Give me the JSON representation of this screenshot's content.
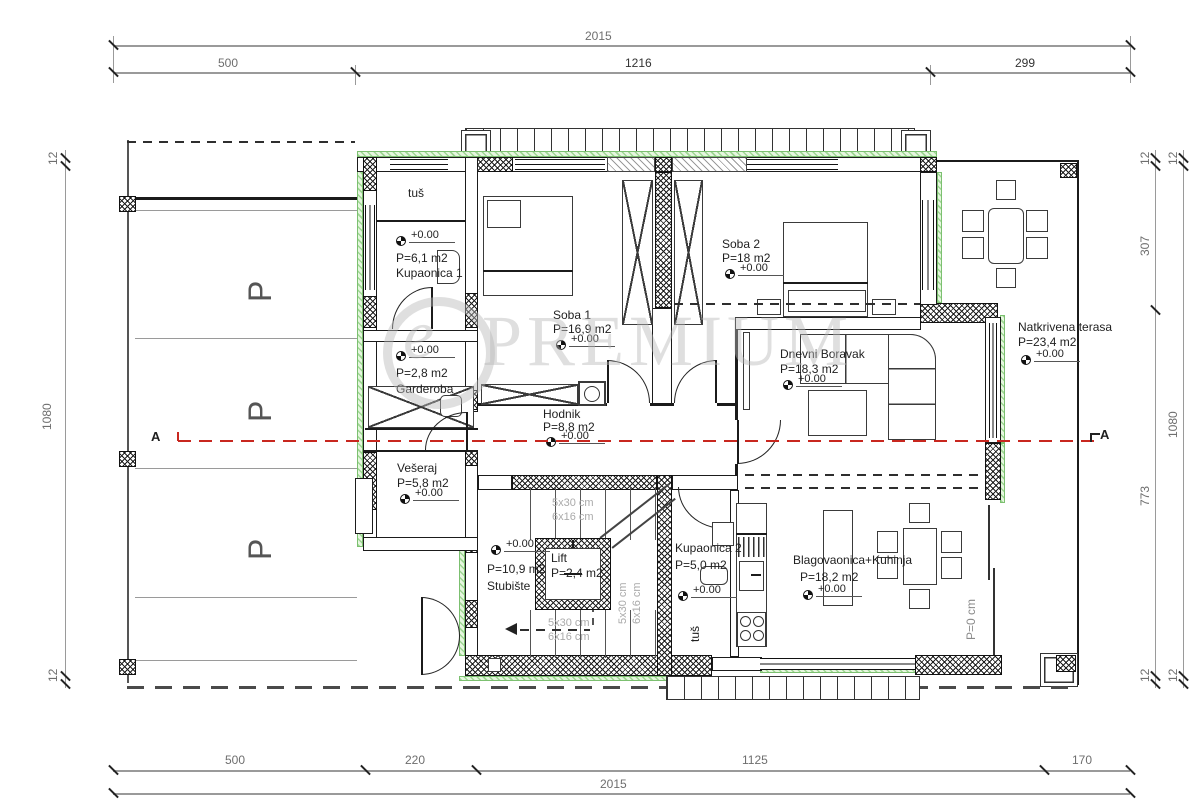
{
  "drawing": {
    "type": "floor-plan",
    "watermark": {
      "logo": "e",
      "text": "PREMIUM"
    },
    "elevation": "+0.00",
    "section": {
      "label": "A"
    },
    "parking": {
      "symbol": "P"
    },
    "terrace_door": "P=0 cm",
    "stairs": {
      "tread": "5x30 cm",
      "riser": "6x16 cm"
    },
    "rooms": {
      "tus": {
        "name": "tuš"
      },
      "kupaonica1": {
        "name": "Kupaonica 1",
        "area": "P=6,1 m2"
      },
      "garderoba": {
        "name": "Garderoba",
        "area": "P=2,8 m2"
      },
      "soba1": {
        "name": "Soba 1",
        "area": "P=16,9 m2"
      },
      "soba2": {
        "name": "Soba 2",
        "area": "P=18 m2"
      },
      "dnevni": {
        "name": "Dnevni Boravak",
        "area": "P=18,3 m2"
      },
      "terasa": {
        "name": "Natkrivena terasa",
        "area": "P=23,4 m2"
      },
      "hodnik": {
        "name": "Hodnik",
        "area": "P=8,8 m2"
      },
      "veseraj": {
        "name": "Vešeraj",
        "area": "P=5,8 m2"
      },
      "stubiste": {
        "name": "Stubište",
        "area": "P=10,9 m2"
      },
      "lift": {
        "name": "Lift",
        "area": "P=2,4 m2"
      },
      "kupaonica2": {
        "name": "Kupaonica 2",
        "area": "P=5,0 m2",
        "shower": "tuš"
      },
      "blagovaonica": {
        "name": "Blagovaonica+Kuhinja",
        "area": "P=18,2 m2"
      }
    },
    "dims": {
      "top_total": "2015",
      "top": [
        "500",
        "1216",
        "299"
      ],
      "bottom": [
        "500",
        "220",
        "1125",
        "170"
      ],
      "bottom_total": "2015",
      "left": [
        "12",
        "1080",
        "12"
      ],
      "right_inner": [
        "12",
        "307",
        "773",
        "12"
      ],
      "right_outer": [
        "12",
        "1080",
        "12"
      ]
    },
    "colors": {
      "insulation_green": "#8fcf84",
      "section_red": "#c8271f",
      "watermark_gray": "#cfcfcf"
    }
  }
}
